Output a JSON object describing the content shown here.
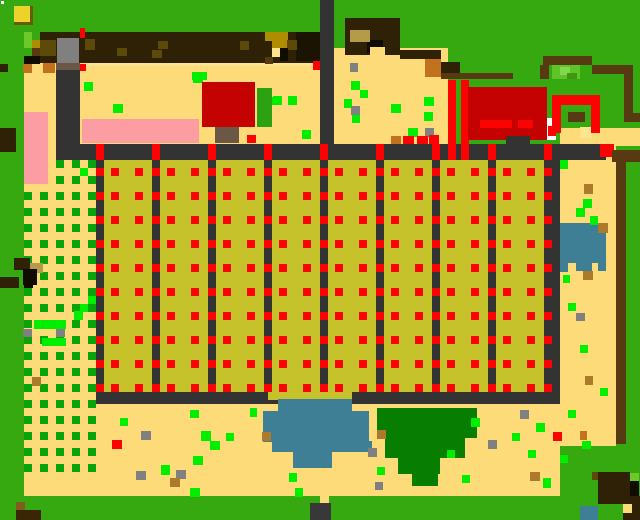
{
  "scene": {
    "label": "pixel-farm-map",
    "width": 640,
    "height": 520
  },
  "palette": {
    "grass": "#35a90f",
    "grasslt": "#6fc829",
    "bush": "#5ec528",
    "bushlt": "#82d84a",
    "bushdk": "#3f9711",
    "bldbush": "#2ca212",
    "sand": "#fcdb78",
    "sandlt": "#fde48e",
    "path": "#333333",
    "tree": "#2e2105",
    "treedk": "#1c1403",
    "fence": "#573a12",
    "khaki": "#b39b4a",
    "dkolive": "#5b4a08",
    "briteol": "#b08d00",
    "crop": "#c5c22b",
    "red": "#fb0303",
    "dred": "#c40202",
    "pink": "#fb9da3",
    "blue": "#3e7f96",
    "dgreen": "#077e01",
    "cgreen": "#0aa30a",
    "lime": "#00ef00",
    "gray": "#808080",
    "orange": "#c2711d",
    "trunk": "#6b5746",
    "gold": "#ab7a2b",
    "white": "#ffffff",
    "black": "#100c02",
    "brownlt": "#815c1f",
    "browndk": "#3a2505",
    "yellow": "#ecd22b",
    "yellowdk": "#6b5a00",
    "marker": "#383838"
  },
  "layers": {
    "base": "grass",
    "sand_rects": [
      [
        24,
        60,
        296,
        100,
        "sand"
      ],
      [
        334,
        48,
        114,
        112,
        "sand"
      ],
      [
        560,
        128,
        80,
        18,
        "sand"
      ],
      [
        560,
        146,
        56,
        300,
        "sand"
      ],
      [
        24,
        160,
        72,
        336,
        "sand"
      ],
      [
        96,
        404,
        464,
        92,
        "sand"
      ],
      [
        86,
        60,
        227,
        6,
        "sandlt"
      ],
      [
        580,
        127,
        12,
        11,
        "sandlt"
      ],
      [
        320,
        496,
        9,
        24,
        "sand"
      ]
    ],
    "checker": {
      "cols": [
        24,
        40,
        56,
        72,
        88
      ],
      "row_start": 160,
      "row_end": 464,
      "row_step": 16,
      "size": 8,
      "color": "cgreen"
    },
    "rects": [
      [
        34,
        320,
        16,
        9,
        "lime"
      ],
      [
        50,
        320,
        16,
        9,
        "lime"
      ],
      [
        80,
        304,
        8,
        8,
        "lime"
      ],
      [
        74,
        311,
        9,
        9,
        "lime"
      ],
      [
        42,
        338,
        24,
        8,
        "lime"
      ],
      [
        80,
        168,
        8,
        8,
        "lime"
      ],
      [
        88,
        296,
        8,
        8,
        "lime"
      ],
      [
        23,
        329,
        9,
        8,
        "gray"
      ],
      [
        56,
        329,
        9,
        8,
        "gray"
      ],
      [
        32,
        377,
        9,
        9,
        "gold"
      ],
      [
        24,
        112,
        24,
        72,
        "pink"
      ],
      [
        82,
        119,
        117,
        24,
        "pink"
      ],
      [
        14,
        258,
        16,
        12,
        "tree"
      ],
      [
        30,
        263,
        13,
        10,
        "khaki"
      ],
      [
        23,
        269,
        14,
        16,
        "black"
      ],
      [
        0,
        277,
        19,
        11,
        "tree"
      ],
      [
        24,
        282,
        9,
        6,
        "black"
      ],
      [
        0,
        64,
        8,
        8,
        "tree"
      ],
      [
        0,
        128,
        16,
        24,
        "tree"
      ],
      [
        40,
        32,
        280,
        31,
        "tree"
      ],
      [
        296,
        32,
        24,
        29,
        "treedk"
      ],
      [
        57,
        38,
        22,
        25,
        "gray"
      ],
      [
        24,
        32,
        8,
        8,
        "grasslt"
      ],
      [
        24,
        40,
        8,
        8,
        "grasslt"
      ],
      [
        32,
        40,
        8,
        8,
        "briteol"
      ],
      [
        40,
        40,
        16,
        16,
        "dkolive"
      ],
      [
        32,
        48,
        8,
        8,
        "fence"
      ],
      [
        24,
        56,
        16,
        8,
        "black"
      ],
      [
        85,
        39,
        10,
        11,
        "dkolive"
      ],
      [
        117,
        48,
        10,
        8,
        "dkolive"
      ],
      [
        152,
        50,
        10,
        8,
        "dkolive"
      ],
      [
        158,
        41,
        10,
        8,
        "dkolive"
      ],
      [
        240,
        41,
        9,
        9,
        "dkolive"
      ],
      [
        265,
        32,
        23,
        9,
        "briteol"
      ],
      [
        272,
        41,
        15,
        7,
        "briteol"
      ],
      [
        287,
        40,
        10,
        10,
        "dkolive"
      ],
      [
        272,
        48,
        8,
        9,
        "sandlt"
      ],
      [
        280,
        48,
        8,
        13,
        "black"
      ],
      [
        265,
        57,
        8,
        7,
        "fence"
      ],
      [
        80,
        28,
        5,
        10,
        "red"
      ],
      [
        80,
        64,
        6,
        7,
        "red"
      ],
      [
        313,
        61,
        10,
        9,
        "red"
      ],
      [
        345,
        18,
        55,
        37,
        "tree"
      ],
      [
        367,
        40,
        16,
        13,
        "black"
      ],
      [
        350,
        30,
        20,
        12,
        "khaki"
      ],
      [
        370,
        47,
        15,
        8,
        "sand"
      ],
      [
        400,
        50,
        41,
        9,
        "tree"
      ],
      [
        425,
        59,
        16,
        18,
        "orange"
      ],
      [
        441,
        62,
        19,
        16,
        "tree"
      ],
      [
        441,
        73,
        72,
        6,
        "fence"
      ],
      [
        543,
        56,
        49,
        9,
        "fence"
      ],
      [
        540,
        65,
        9,
        14,
        "fence"
      ],
      [
        592,
        65,
        41,
        9,
        "fence"
      ],
      [
        624,
        74,
        9,
        39,
        "fence"
      ],
      [
        624,
        113,
        16,
        9,
        "fence"
      ],
      [
        552,
        65,
        28,
        14,
        "bush"
      ],
      [
        560,
        67,
        10,
        8,
        "bushlt"
      ],
      [
        567,
        73,
        10,
        6,
        "bushdk"
      ],
      [
        23,
        64,
        9,
        9,
        "orange"
      ],
      [
        43,
        63,
        12,
        10,
        "orange"
      ],
      [
        84,
        82,
        9,
        9,
        "lime"
      ],
      [
        113,
        104,
        10,
        9,
        "lime"
      ],
      [
        193,
        74,
        10,
        9,
        "lime"
      ],
      [
        273,
        96,
        9,
        9,
        "lime"
      ],
      [
        288,
        96,
        9,
        9,
        "lime"
      ],
      [
        302,
        130,
        9,
        9,
        "lime"
      ],
      [
        351,
        81,
        9,
        9,
        "lime"
      ],
      [
        360,
        90,
        8,
        8,
        "lime"
      ],
      [
        344,
        99,
        8,
        9,
        "lime"
      ],
      [
        352,
        115,
        8,
        8,
        "lime"
      ],
      [
        350,
        63,
        8,
        9,
        "gray"
      ],
      [
        351,
        106,
        9,
        9,
        "gray"
      ],
      [
        391,
        104,
        10,
        9,
        "lime"
      ],
      [
        424,
        97,
        10,
        9,
        "lime"
      ],
      [
        424,
        112,
        9,
        9,
        "lime"
      ],
      [
        408,
        128,
        10,
        9,
        "lime"
      ],
      [
        425,
        128,
        9,
        9,
        "gray"
      ],
      [
        391,
        136,
        10,
        9,
        "orange"
      ],
      [
        403,
        136,
        11,
        9,
        "red"
      ],
      [
        417,
        136,
        11,
        9,
        "red"
      ],
      [
        429,
        135,
        10,
        10,
        "red"
      ],
      [
        448,
        80,
        8,
        64,
        "red"
      ],
      [
        461,
        80,
        8,
        64,
        "red"
      ],
      [
        202,
        82,
        53,
        45,
        "dred"
      ],
      [
        257,
        88,
        15,
        39,
        "bldbush"
      ],
      [
        215,
        127,
        24,
        16,
        "trunk"
      ],
      [
        247,
        135,
        9,
        8,
        "red"
      ],
      [
        192,
        72,
        15,
        8,
        "lime"
      ],
      [
        272,
        97,
        8,
        8,
        "lime"
      ],
      [
        289,
        97,
        8,
        8,
        "lime"
      ],
      [
        468,
        87,
        79,
        53,
        "dred"
      ],
      [
        480,
        120,
        32,
        8,
        "red"
      ],
      [
        518,
        120,
        15,
        8,
        "red"
      ],
      [
        547,
        118,
        9,
        22,
        "white"
      ],
      [
        548,
        126,
        8,
        10,
        "red"
      ],
      [
        506,
        136,
        24,
        11,
        "path"
      ],
      [
        552,
        95,
        48,
        10,
        "red"
      ],
      [
        552,
        105,
        9,
        28,
        "red"
      ],
      [
        591,
        105,
        9,
        28,
        "red"
      ],
      [
        568,
        112,
        17,
        10,
        "fence"
      ],
      [
        320,
        0,
        14,
        146,
        "path"
      ],
      [
        56,
        63,
        24,
        81,
        "path"
      ],
      [
        56,
        63,
        24,
        7,
        "trunk"
      ],
      [
        56,
        144,
        550,
        16,
        "path"
      ],
      [
        600,
        144,
        14,
        13,
        "red"
      ],
      [
        612,
        150,
        28,
        12,
        "fence"
      ],
      [
        616,
        162,
        10,
        282,
        "fence"
      ]
    ],
    "field": {
      "x0": 96,
      "y_top": 144,
      "pitch": 56,
      "plots": 8,
      "path_w": 8,
      "last_path_w": 16,
      "crop_rect": [
        96,
        160,
        464,
        232
      ],
      "v_path_h": 260,
      "bottom_path": [
        96,
        392,
        464,
        12
      ],
      "gap_patch": [
        268,
        392,
        84,
        8
      ],
      "tick": {
        "h": 16,
        "w": 8,
        "color": "red"
      },
      "dots": {
        "row_start": 168,
        "row_end": 384,
        "row_step": 24,
        "size": 8,
        "col_offsets": [
          15,
          39
        ],
        "color": "red"
      },
      "plot_color": "crop",
      "path_color": "path"
    },
    "overlay": [
      [
        448,
        144,
        8,
        16,
        "red"
      ],
      [
        461,
        144,
        8,
        16,
        "red"
      ],
      [
        278,
        399,
        74,
        13,
        "blue"
      ],
      [
        263,
        411,
        106,
        31,
        "blue"
      ],
      [
        272,
        442,
        84,
        10,
        "blue"
      ],
      [
        293,
        452,
        39,
        16,
        "blue"
      ],
      [
        356,
        441,
        16,
        11,
        "blue"
      ],
      [
        377,
        408,
        100,
        30,
        "dgreen"
      ],
      [
        385,
        438,
        80,
        20,
        "dgreen"
      ],
      [
        398,
        458,
        42,
        16,
        "dgreen"
      ],
      [
        412,
        474,
        26,
        12,
        "dgreen"
      ],
      [
        377,
        430,
        9,
        9,
        "gold"
      ],
      [
        368,
        448,
        9,
        9,
        "gray"
      ],
      [
        471,
        418,
        9,
        9,
        "lime"
      ],
      [
        560,
        223,
        46,
        40,
        "blue"
      ],
      [
        560,
        263,
        8,
        9,
        "blue"
      ],
      [
        576,
        263,
        16,
        8,
        "blue"
      ],
      [
        598,
        263,
        8,
        8,
        "blue"
      ],
      [
        598,
        223,
        10,
        10,
        "gold"
      ],
      [
        560,
        160,
        8,
        9,
        "lime"
      ],
      [
        584,
        184,
        9,
        10,
        "gold"
      ],
      [
        583,
        199,
        9,
        9,
        "lime"
      ],
      [
        576,
        208,
        9,
        9,
        "lime"
      ],
      [
        590,
        216,
        8,
        9,
        "lime"
      ],
      [
        563,
        275,
        7,
        8,
        "lime"
      ],
      [
        583,
        271,
        10,
        9,
        "gold"
      ],
      [
        568,
        303,
        8,
        8,
        "lime"
      ],
      [
        576,
        313,
        9,
        8,
        "gray"
      ],
      [
        580,
        345,
        8,
        8,
        "lime"
      ],
      [
        585,
        376,
        8,
        9,
        "gold"
      ],
      [
        600,
        388,
        8,
        8,
        "lime"
      ],
      [
        568,
        410,
        8,
        8,
        "lime"
      ],
      [
        580,
        431,
        7,
        9,
        "orange"
      ],
      [
        582,
        441,
        9,
        8,
        "lime"
      ],
      [
        190,
        410,
        9,
        8,
        "lime"
      ],
      [
        201,
        431,
        10,
        10,
        "lime"
      ],
      [
        226,
        433,
        8,
        8,
        "lime"
      ],
      [
        210,
        441,
        10,
        9,
        "lime"
      ],
      [
        193,
        456,
        10,
        9,
        "lime"
      ],
      [
        161,
        465,
        9,
        10,
        "lime"
      ],
      [
        190,
        488,
        10,
        9,
        "lime"
      ],
      [
        120,
        418,
        8,
        8,
        "lime"
      ],
      [
        141,
        431,
        10,
        9,
        "gray"
      ],
      [
        136,
        471,
        10,
        9,
        "gray"
      ],
      [
        176,
        470,
        10,
        9,
        "gray"
      ],
      [
        262,
        432,
        9,
        9,
        "gold"
      ],
      [
        170,
        478,
        10,
        9,
        "gold"
      ],
      [
        112,
        440,
        10,
        9,
        "red"
      ],
      [
        250,
        408,
        7,
        9,
        "lime"
      ],
      [
        289,
        473,
        8,
        9,
        "lime"
      ],
      [
        295,
        488,
        8,
        9,
        "lime"
      ],
      [
        377,
        467,
        8,
        8,
        "lime"
      ],
      [
        375,
        482,
        8,
        8,
        "gray"
      ],
      [
        462,
        475,
        8,
        8,
        "lime"
      ],
      [
        447,
        450,
        8,
        8,
        "lime"
      ],
      [
        512,
        433,
        8,
        8,
        "lime"
      ],
      [
        528,
        450,
        8,
        8,
        "lime"
      ],
      [
        536,
        423,
        9,
        9,
        "lime"
      ],
      [
        543,
        478,
        8,
        10,
        "lime"
      ],
      [
        553,
        432,
        9,
        9,
        "red"
      ],
      [
        488,
        440,
        9,
        9,
        "gray"
      ],
      [
        520,
        410,
        9,
        9,
        "gray"
      ],
      [
        530,
        472,
        10,
        9,
        "gold"
      ],
      [
        560,
        455,
        8,
        8,
        "lime"
      ],
      [
        16,
        502,
        9,
        8,
        "brownlt"
      ],
      [
        16,
        510,
        25,
        10,
        "browndk"
      ],
      [
        598,
        472,
        32,
        32,
        "tree"
      ],
      [
        630,
        481,
        9,
        15,
        "black"
      ],
      [
        623,
        496,
        17,
        24,
        "tree"
      ],
      [
        623,
        504,
        9,
        9,
        "sand"
      ],
      [
        580,
        506,
        18,
        14,
        "blue"
      ],
      [
        630,
        473,
        9,
        8,
        "grasslt"
      ],
      [
        592,
        472,
        6,
        8,
        "dkolive"
      ],
      [
        1,
        1,
        3,
        3,
        "white"
      ],
      [
        14,
        6,
        16,
        16,
        "yellow"
      ],
      [
        30,
        6,
        3,
        19,
        "yellowdk"
      ],
      [
        14,
        22,
        19,
        3,
        "yellowdk"
      ],
      [
        310,
        503,
        21,
        17,
        "marker"
      ]
    ]
  }
}
